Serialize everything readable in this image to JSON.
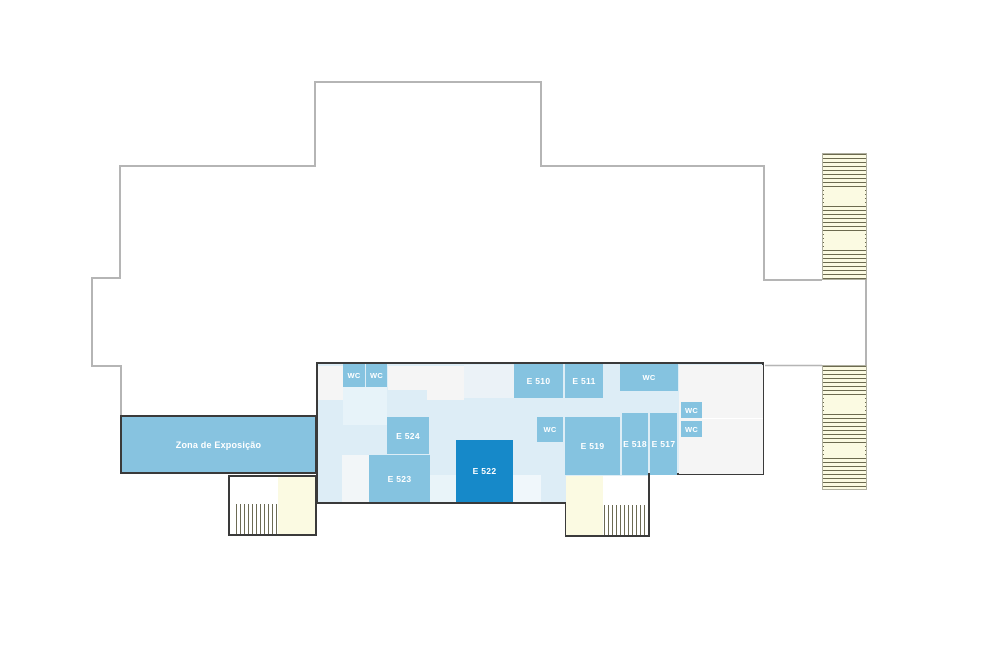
{
  "plan": {
    "exhibition_zone_label": "Zona de Exposição",
    "wc_label": "WC",
    "rooms": [
      {
        "id": "e510",
        "label": "E 510"
      },
      {
        "id": "e511",
        "label": "E 511"
      },
      {
        "id": "e517",
        "label": "E 517"
      },
      {
        "id": "e518",
        "label": "E 518"
      },
      {
        "id": "e519",
        "label": "E 519"
      },
      {
        "id": "e522",
        "label": "E 522",
        "highlighted": true
      },
      {
        "id": "e523",
        "label": "E 523"
      },
      {
        "id": "e524",
        "label": "E 524"
      }
    ],
    "wc_count": 6,
    "colors": {
      "room_blue": "#85c3e0",
      "room_highlight_blue": "#1689c9",
      "floor_background_blue": "#ddedf6",
      "vacant_unit_gray": "#f5f5f5",
      "stairs_yellow": "#fbfae2",
      "stairs_line_olive": "#48462a",
      "building_outline_gray": "#b5b5b5",
      "floor_border_dark": "#3a3a3a",
      "label_text": "#ffffff"
    }
  }
}
